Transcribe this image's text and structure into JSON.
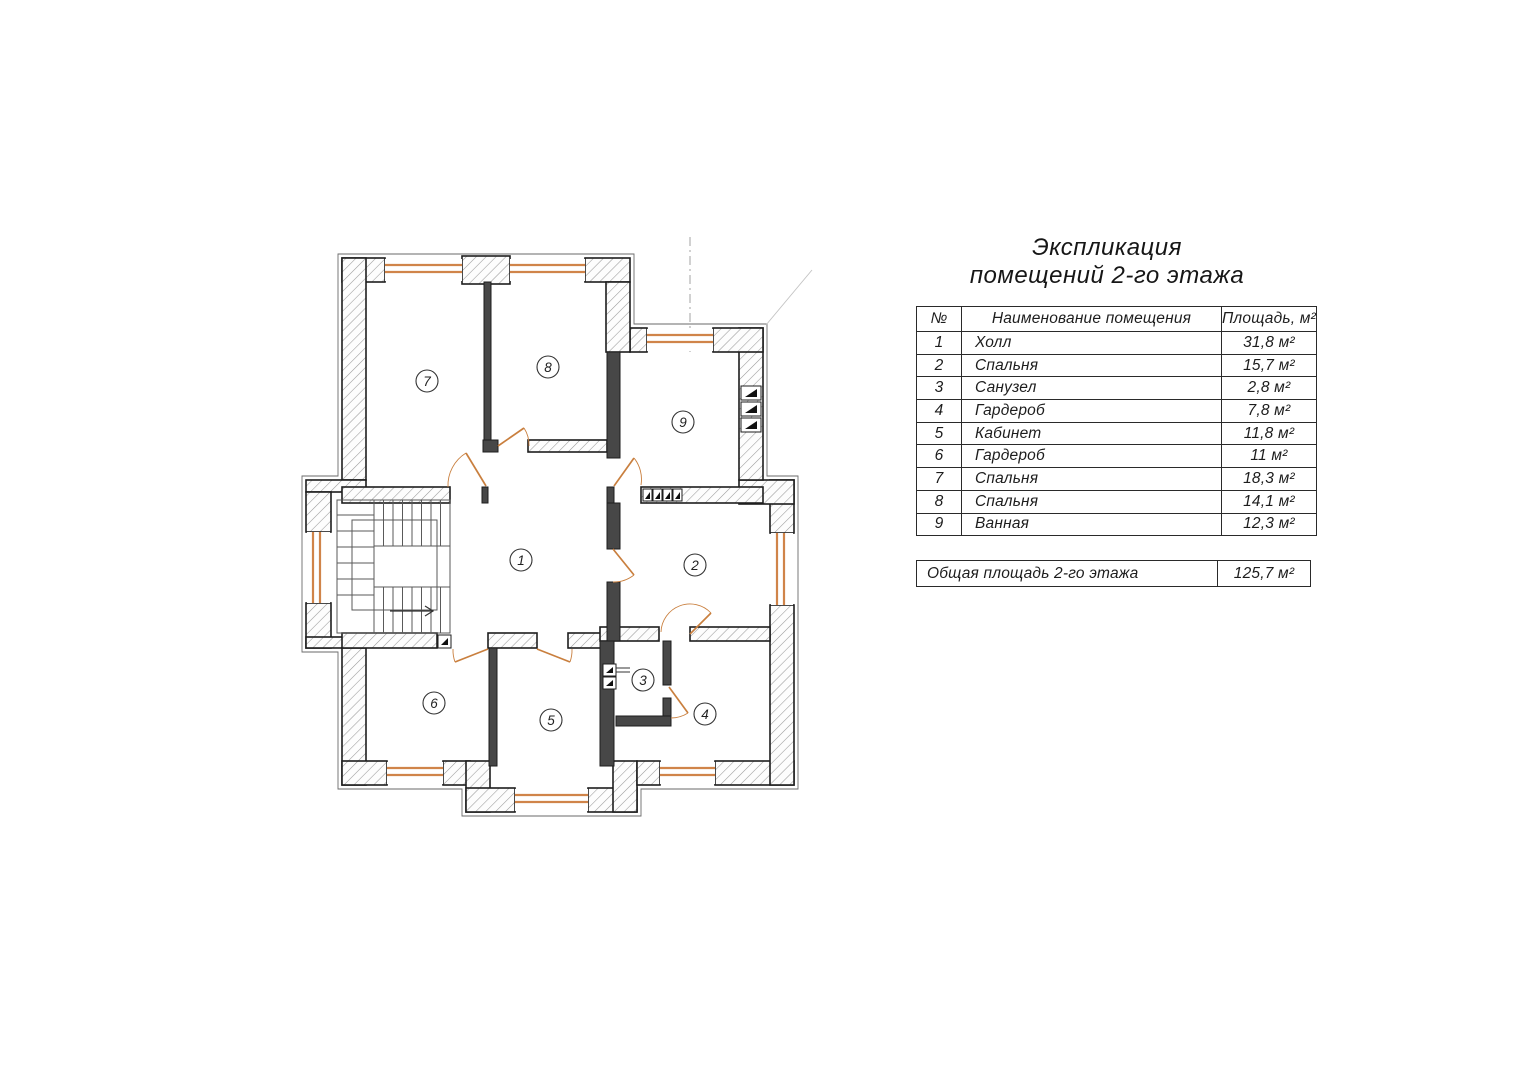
{
  "title": {
    "line1": "Экспликация",
    "line2": "помещений 2-го этажа"
  },
  "table": {
    "headers": {
      "num": "№",
      "name": "Наименование помещения",
      "area": "Площадь, м²"
    },
    "rows": [
      {
        "num": "1",
        "name": "Холл",
        "area": "31,8 м²"
      },
      {
        "num": "2",
        "name": "Спальня",
        "area": "15,7 м²"
      },
      {
        "num": "3",
        "name": "Санузел",
        "area": "2,8 м²"
      },
      {
        "num": "4",
        "name": "Гардероб",
        "area": "7,8 м²"
      },
      {
        "num": "5",
        "name": "Кабинет",
        "area": "11,8 м²"
      },
      {
        "num": "6",
        "name": "Гардероб",
        "area": "11 м²"
      },
      {
        "num": "7",
        "name": "Спальня",
        "area": "18,3 м²"
      },
      {
        "num": "8",
        "name": "Спальня",
        "area": "14,1 м²"
      },
      {
        "num": "9",
        "name": "Ванная",
        "area": "12,3 м²"
      }
    ],
    "total": {
      "label": "Общая площадь 2-го этажа",
      "area": "125,7 м²"
    }
  },
  "plan": {
    "room_numbers": [
      "1",
      "2",
      "3",
      "4",
      "5",
      "6",
      "7",
      "8",
      "9"
    ]
  },
  "colors": {
    "window": "#d08449",
    "door": "#c97f3e",
    "hatch": "#9a9a9a",
    "wall_outline": "#1e1e1e",
    "accent_dash": "#9a9a9a"
  }
}
